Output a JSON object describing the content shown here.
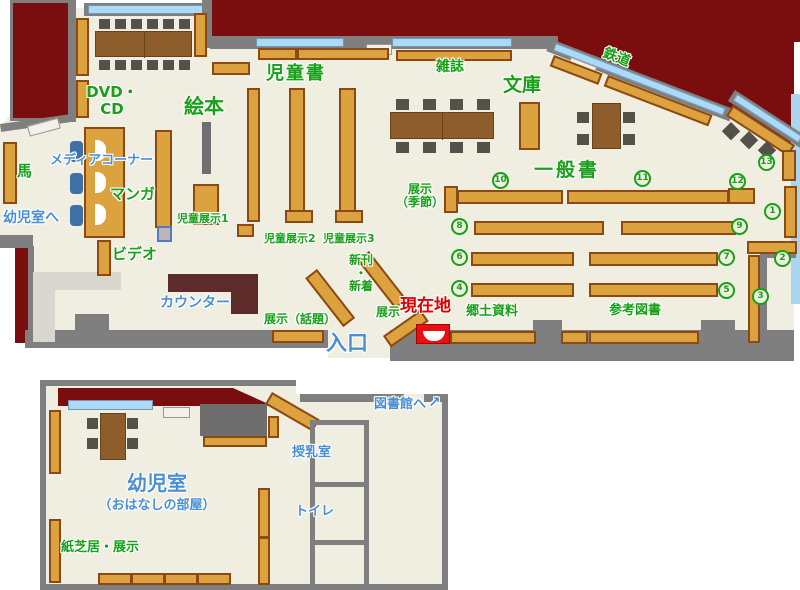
{
  "colors": {
    "floor": "#f0eee1",
    "exterior": "#7a0d0d",
    "wall": "#7f7f7f",
    "shelf": "#dda240",
    "shelf_border": "#8c4a12",
    "table": "#8e5d2c",
    "chair": "#54514a",
    "window": "#abd9f8",
    "media_chair": "#3e6fa5",
    "counter": "#5e2b2b",
    "light_area": "#d9d7cf",
    "outdoor": "#a9d5f1",
    "label_green": "#18a018",
    "label_blue": "#4a8fd4",
    "label_red": "#e00000"
  },
  "main_map": {
    "labels": {
      "dvd_line1": "DVD・",
      "dvd_line2": "CD",
      "ehon": "絵本",
      "uma": "馬",
      "manga": "マンガ",
      "video": "ビデオ",
      "jidosho": "児童書",
      "jido_tenji1": "児童展示1",
      "jido_tenji2": "児童展示2",
      "jido_tenji3": "児童展示3",
      "zasshi": "雑誌",
      "bunko": "文庫",
      "tetsudo": "鉄道",
      "ippansho": "一般書",
      "tenji_kisetsu_line1": "展示",
      "tenji_kisetsu_line2": "（季節）",
      "shinkan_line1": "新刊",
      "shinkan_line2": "・",
      "shinkan_line3": "新着",
      "tenji_wadai": "展示（話題）",
      "tenji": "展示",
      "kyodo_shiryo": "郷土資料",
      "sanko_tosho": "参考図書",
      "media_corner": "メディアコーナー",
      "yojishitsu_e": "幼児室へ",
      "counter": "カウンター",
      "iriguchi": "入口",
      "genzaichi": "現在地"
    },
    "numbers": {
      "n1": "1",
      "n2": "2",
      "n3": "3",
      "n4": "4",
      "n5": "5",
      "n6": "6",
      "n7": "7",
      "n8": "8",
      "n9": "9",
      "n10": "10",
      "n11": "11",
      "n12": "12",
      "n13": "13"
    }
  },
  "lower_map": {
    "labels": {
      "yojishitsu": "幼児室",
      "ohanashi": "（おはなしの部屋）",
      "kamishibai_tenji": "紙芝居・展示",
      "junyushitsu": "授乳室",
      "toire": "トイレ",
      "toshokan_e": "図書館へ",
      "toshokan_arrow": "↗"
    }
  }
}
